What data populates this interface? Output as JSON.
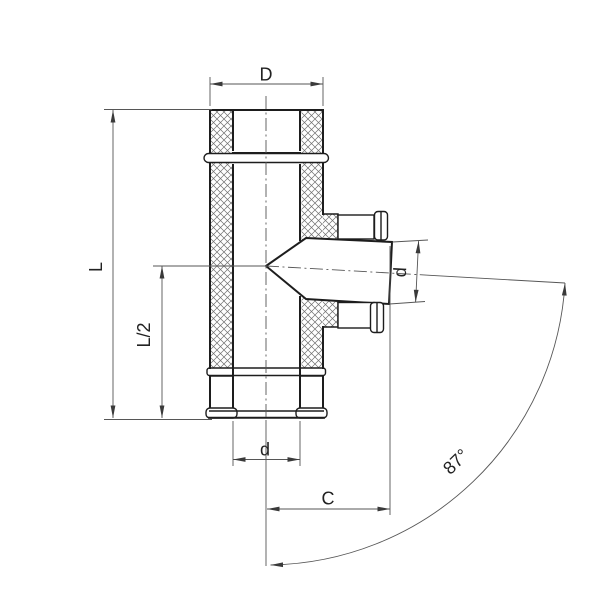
{
  "drawing": {
    "kind": "technical-dimension-drawing",
    "subject": "insulated-tee-fitting-87-degree",
    "labels": {
      "D": "D",
      "L": "L",
      "L_half": "L/2",
      "d_bottom": "d",
      "d_branch": "d",
      "C": "C",
      "angle": "87°"
    },
    "colors": {
      "background": "#ffffff",
      "outline": "#1d1d1d",
      "dimension": "#565656",
      "hatch": "#6f6f6f",
      "text": "#222222"
    }
  }
}
